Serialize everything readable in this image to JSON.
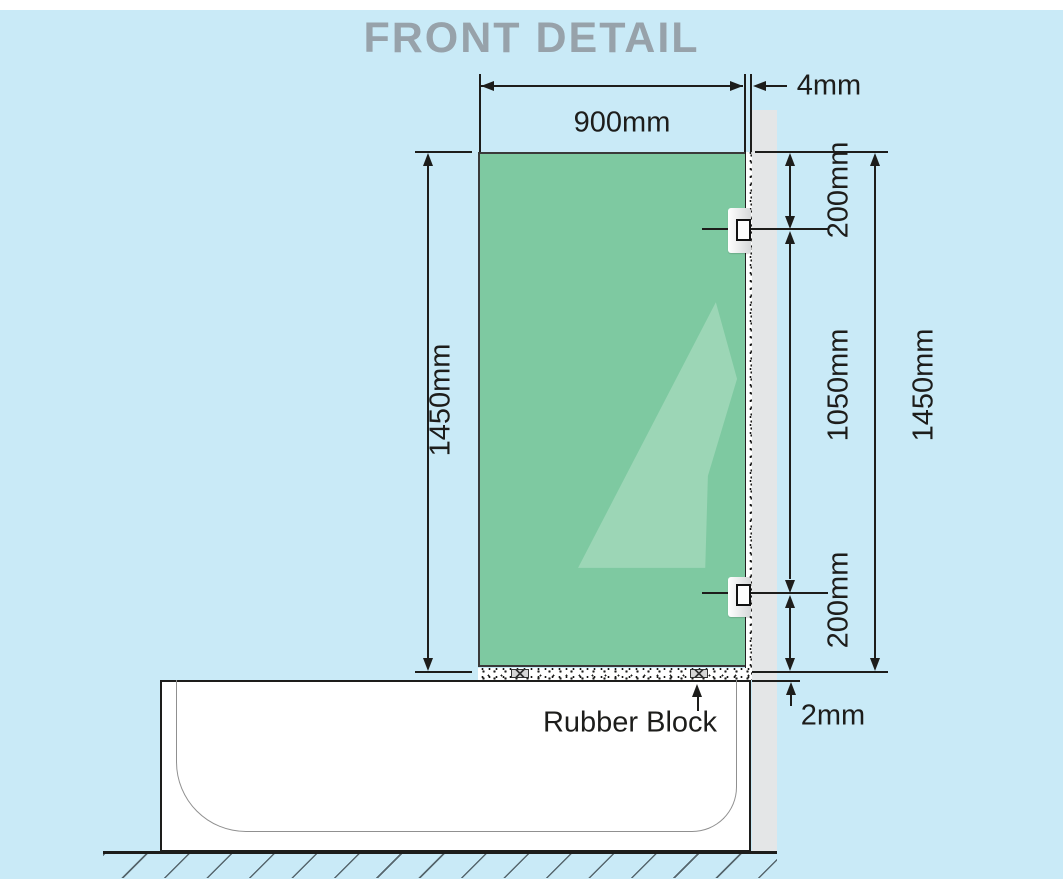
{
  "title": "FRONT DETAIL",
  "dimensions": {
    "glass_width": "900mm",
    "wall_gap": "4mm",
    "glass_height": "1450mm",
    "bracket_top_offset": "200mm",
    "bracket_spacing": "1050mm",
    "bracket_bottom_offset": "200mm",
    "overall_height": "1450mm",
    "bottom_gap": "2mm"
  },
  "labels": {
    "rubber_block": "Rubber Block"
  },
  "colors": {
    "background": "#c9eaf7",
    "glass": "#7ec9a1",
    "glass_highlight": "#9cd6b6",
    "wall": "#e4e6e7",
    "line": "#1d1d1b",
    "title_text": "#97a2aa"
  }
}
